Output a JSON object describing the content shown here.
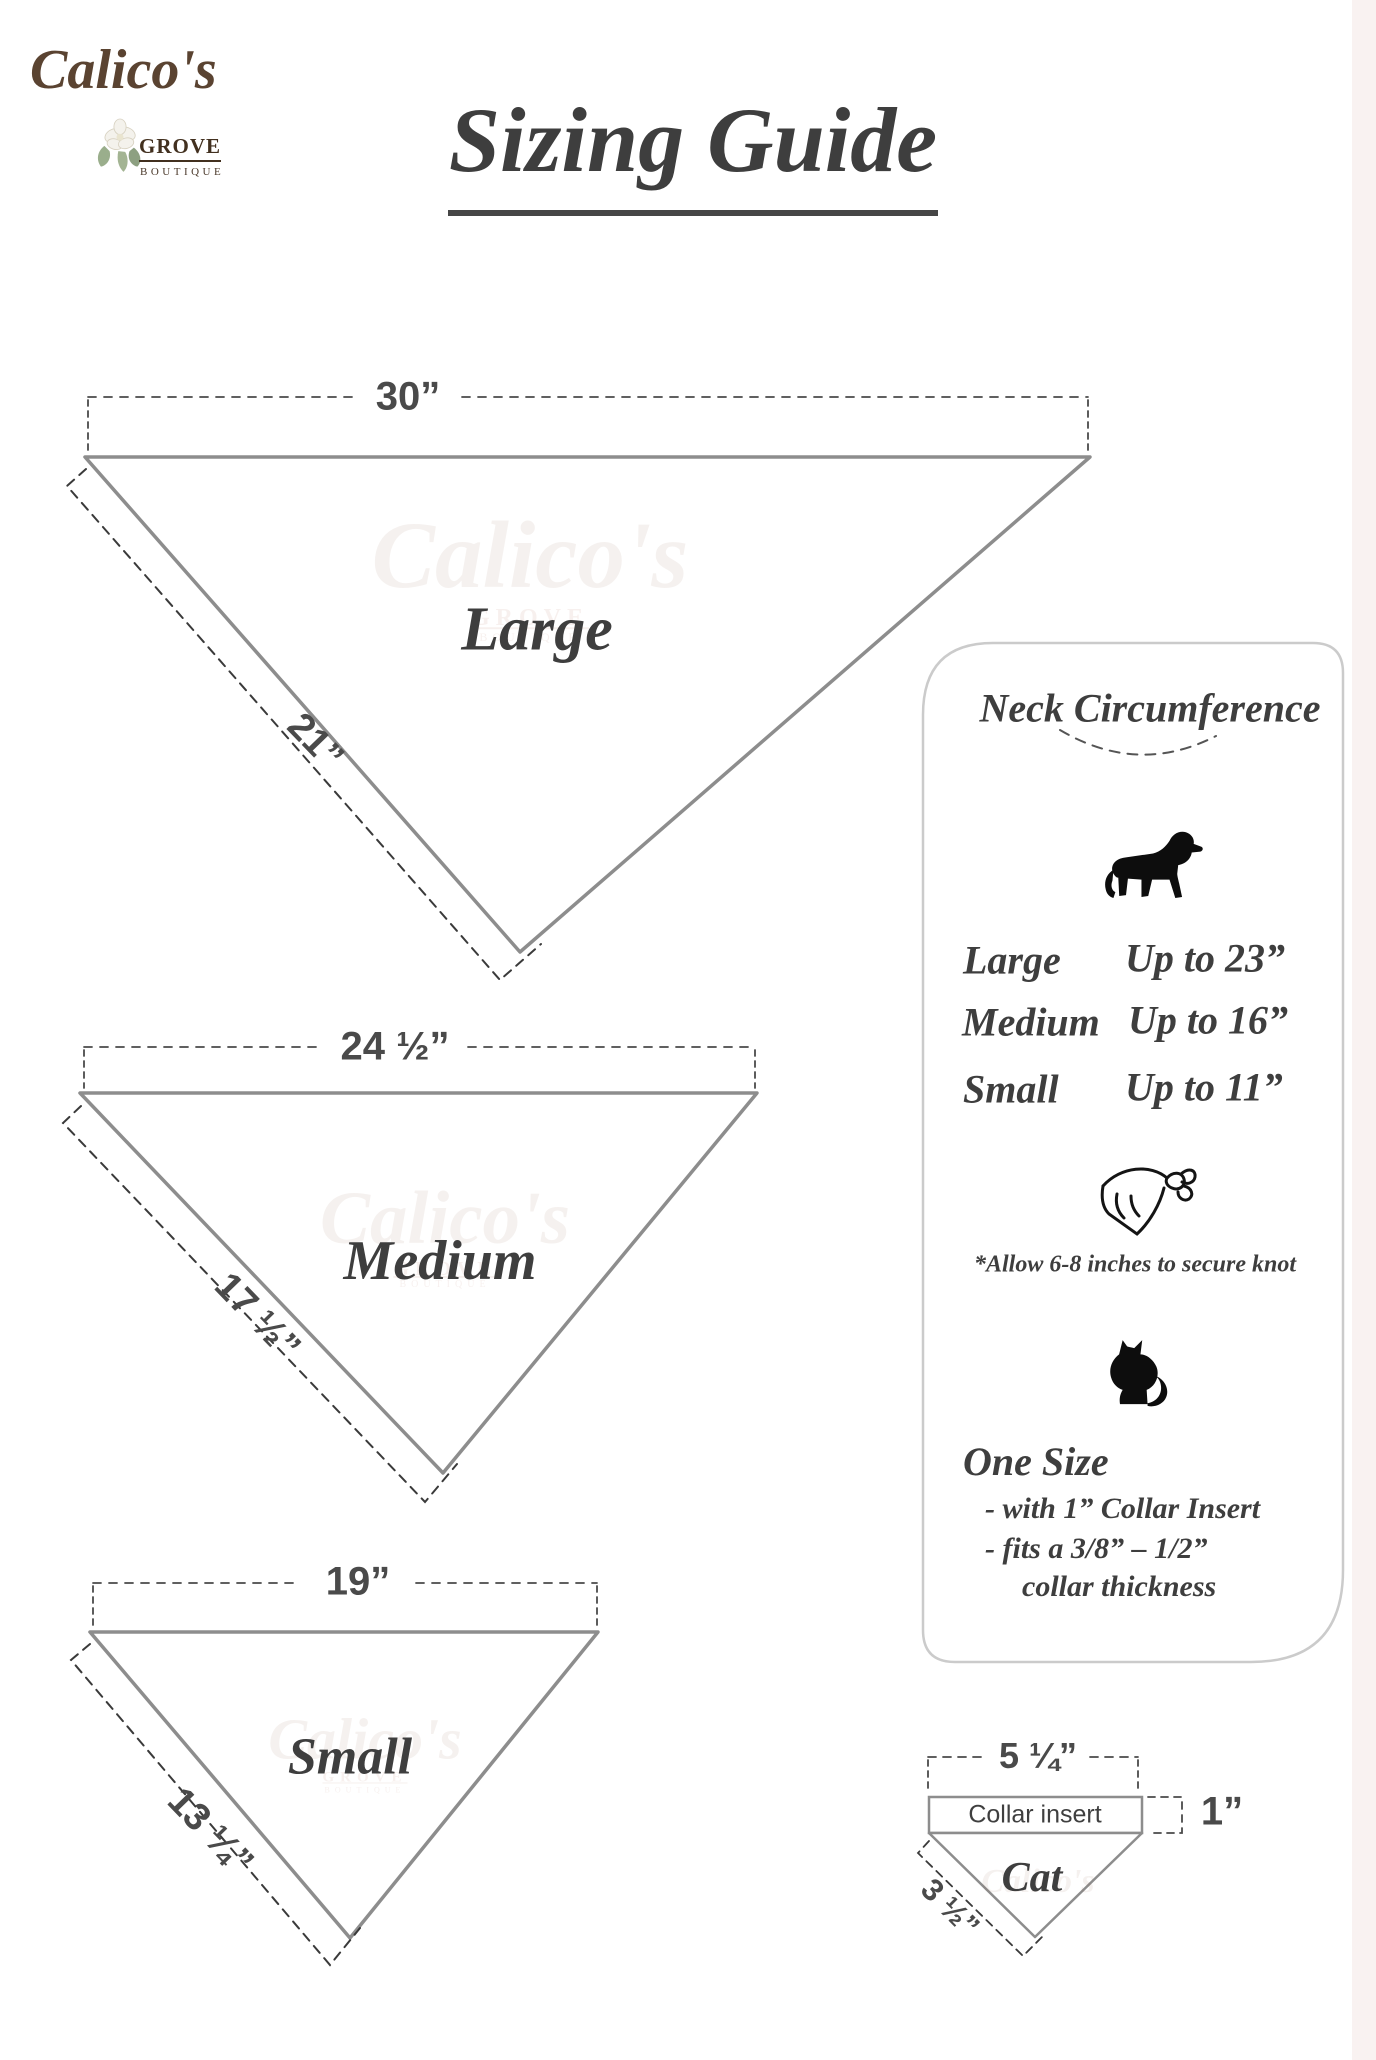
{
  "brand": {
    "name": "Calico's",
    "grove": "GROVE",
    "boutique": "BOUTIQUE"
  },
  "title": "Sizing Guide",
  "triangles": [
    {
      "label": "Large",
      "top": "30”",
      "side": "21”"
    },
    {
      "label": "Medium",
      "top": "24 ½”",
      "side": "17 ½”"
    },
    {
      "label": "Small",
      "top": "19”",
      "side": "13 ¼”"
    }
  ],
  "panel": {
    "title": "Neck Circumference",
    "rows": [
      {
        "size": "Large",
        "value": "Up to 23”"
      },
      {
        "size": "Medium",
        "value": "Up to 16”"
      },
      {
        "size": "Small",
        "value": "Up to 11”"
      }
    ],
    "note": "*Allow 6-8 inches to secure knot",
    "one_size": {
      "heading": "One Size",
      "line1": "- with 1” Collar Insert",
      "line2": "- fits a 3/8” – 1/2”",
      "line3": "collar thickness"
    }
  },
  "cat_diagram": {
    "top": "5 ¼”",
    "insert": "Collar insert",
    "height": "1”",
    "label": "Cat",
    "side": "3 ½”"
  },
  "icons": {
    "dog": "dog-icon",
    "bandana": "bandana-icon",
    "cat": "cat-icon",
    "flower": "flower-icon"
  },
  "colors": {
    "line": "#8d8d8d",
    "dash": "#3a3a3a",
    "text": "#3f3f3f",
    "brand_brown": "#5a4331",
    "panel_border": "#cbcbcb"
  }
}
